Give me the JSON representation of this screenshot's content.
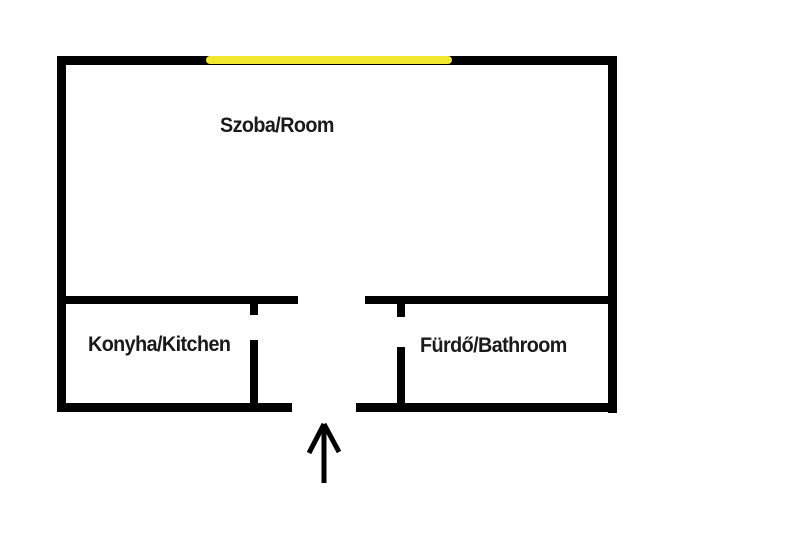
{
  "floorplan": {
    "rooms": {
      "room": {
        "label": "Szoba/Room"
      },
      "kitchen": {
        "label": "Konyha/Kitchen"
      },
      "bathroom": {
        "label": "Fürdő/Bathroom"
      }
    },
    "icons": {
      "entrance": "arrow-up-icon"
    },
    "colors": {
      "wall": "#000000",
      "highlight": "#f0e72f",
      "text": "#1a1a1a",
      "background": "#ffffff"
    }
  }
}
